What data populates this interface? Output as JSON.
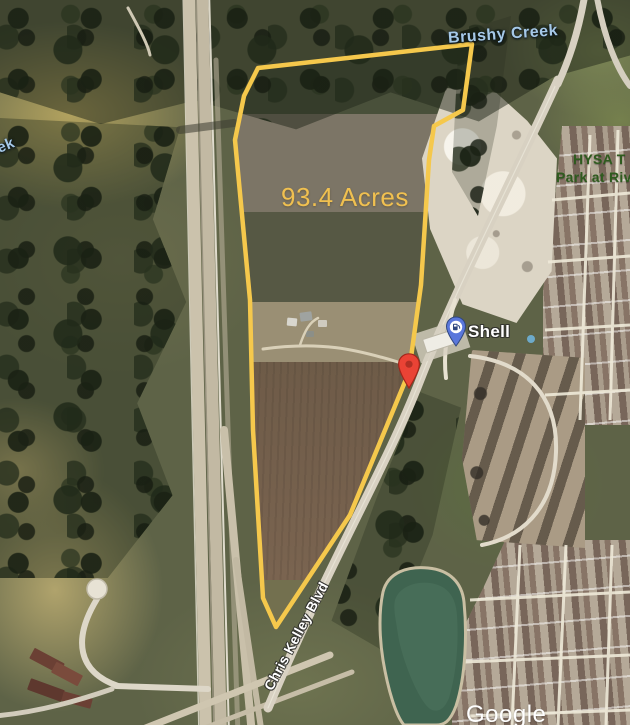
{
  "map": {
    "type": "satellite-view",
    "attribution": "Google",
    "parcel": {
      "acreage_label": "93.4 Acres",
      "outline_points": "258,68 472,44 463,110 434,126 429,160 421,285 409,372 350,515 276,627 263,598 253,430 250,300 235,140 244,96",
      "outline_color": "#F5C84C"
    },
    "labels": {
      "creek": "Brushy Creek",
      "creek_fragment": "ek",
      "park_line1": "HYSA T",
      "park_line2": "Park at Riv",
      "road": "Chris Kelley Blvd",
      "highway_shield": "130",
      "gas_station": "Shell",
      "watermark": "Google"
    },
    "colors": {
      "parcel_outline": "#F5C84C",
      "acreage_text": "#F0C050",
      "water_label": "#A6C9E8",
      "park_label": "#2F5B1E",
      "road_label": "#FFFFFF",
      "red_marker": "#EA4335",
      "gas_pin_blue": "#5A77DB",
      "pond_green": "#3F6450"
    },
    "markers": [
      {
        "name": "red-location-marker",
        "color": "#EA4335"
      },
      {
        "name": "shell-gas-station-pin",
        "label": "Shell",
        "color": "#5A77DB"
      }
    ]
  }
}
